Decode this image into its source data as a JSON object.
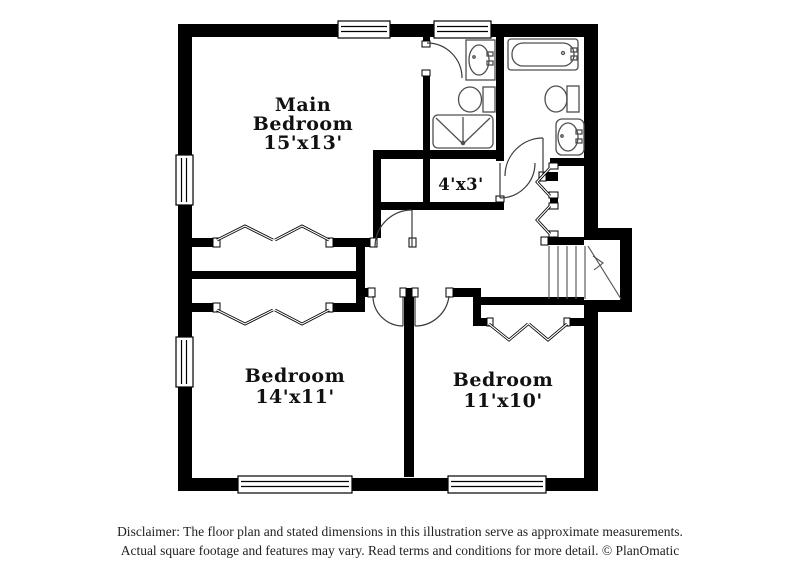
{
  "colors": {
    "background": "#ffffff",
    "wall": "#000000",
    "fixture_line": "#4f4f4f",
    "door_line": "#3a3a3a",
    "label_text": "#111111",
    "disclaimer_text": "#1f1f1f"
  },
  "rooms": {
    "main_bedroom": {
      "line1": "Main",
      "line2": "Bedroom",
      "dims": "15'x13'"
    },
    "closet": {
      "dims": "4'x3'"
    },
    "bedroom_left": {
      "name": "Bedroom",
      "dims": "14'x11'"
    },
    "bedroom_right": {
      "name": "Bedroom",
      "dims": "11'x10'"
    }
  },
  "disclaimer": {
    "line1": "Disclaimer: The floor plan and stated dimensions in this illustration serve as approximate measurements.",
    "line2": "Actual square footage and features may vary. Read terms and conditions for more detail. © PlanOmatic"
  }
}
